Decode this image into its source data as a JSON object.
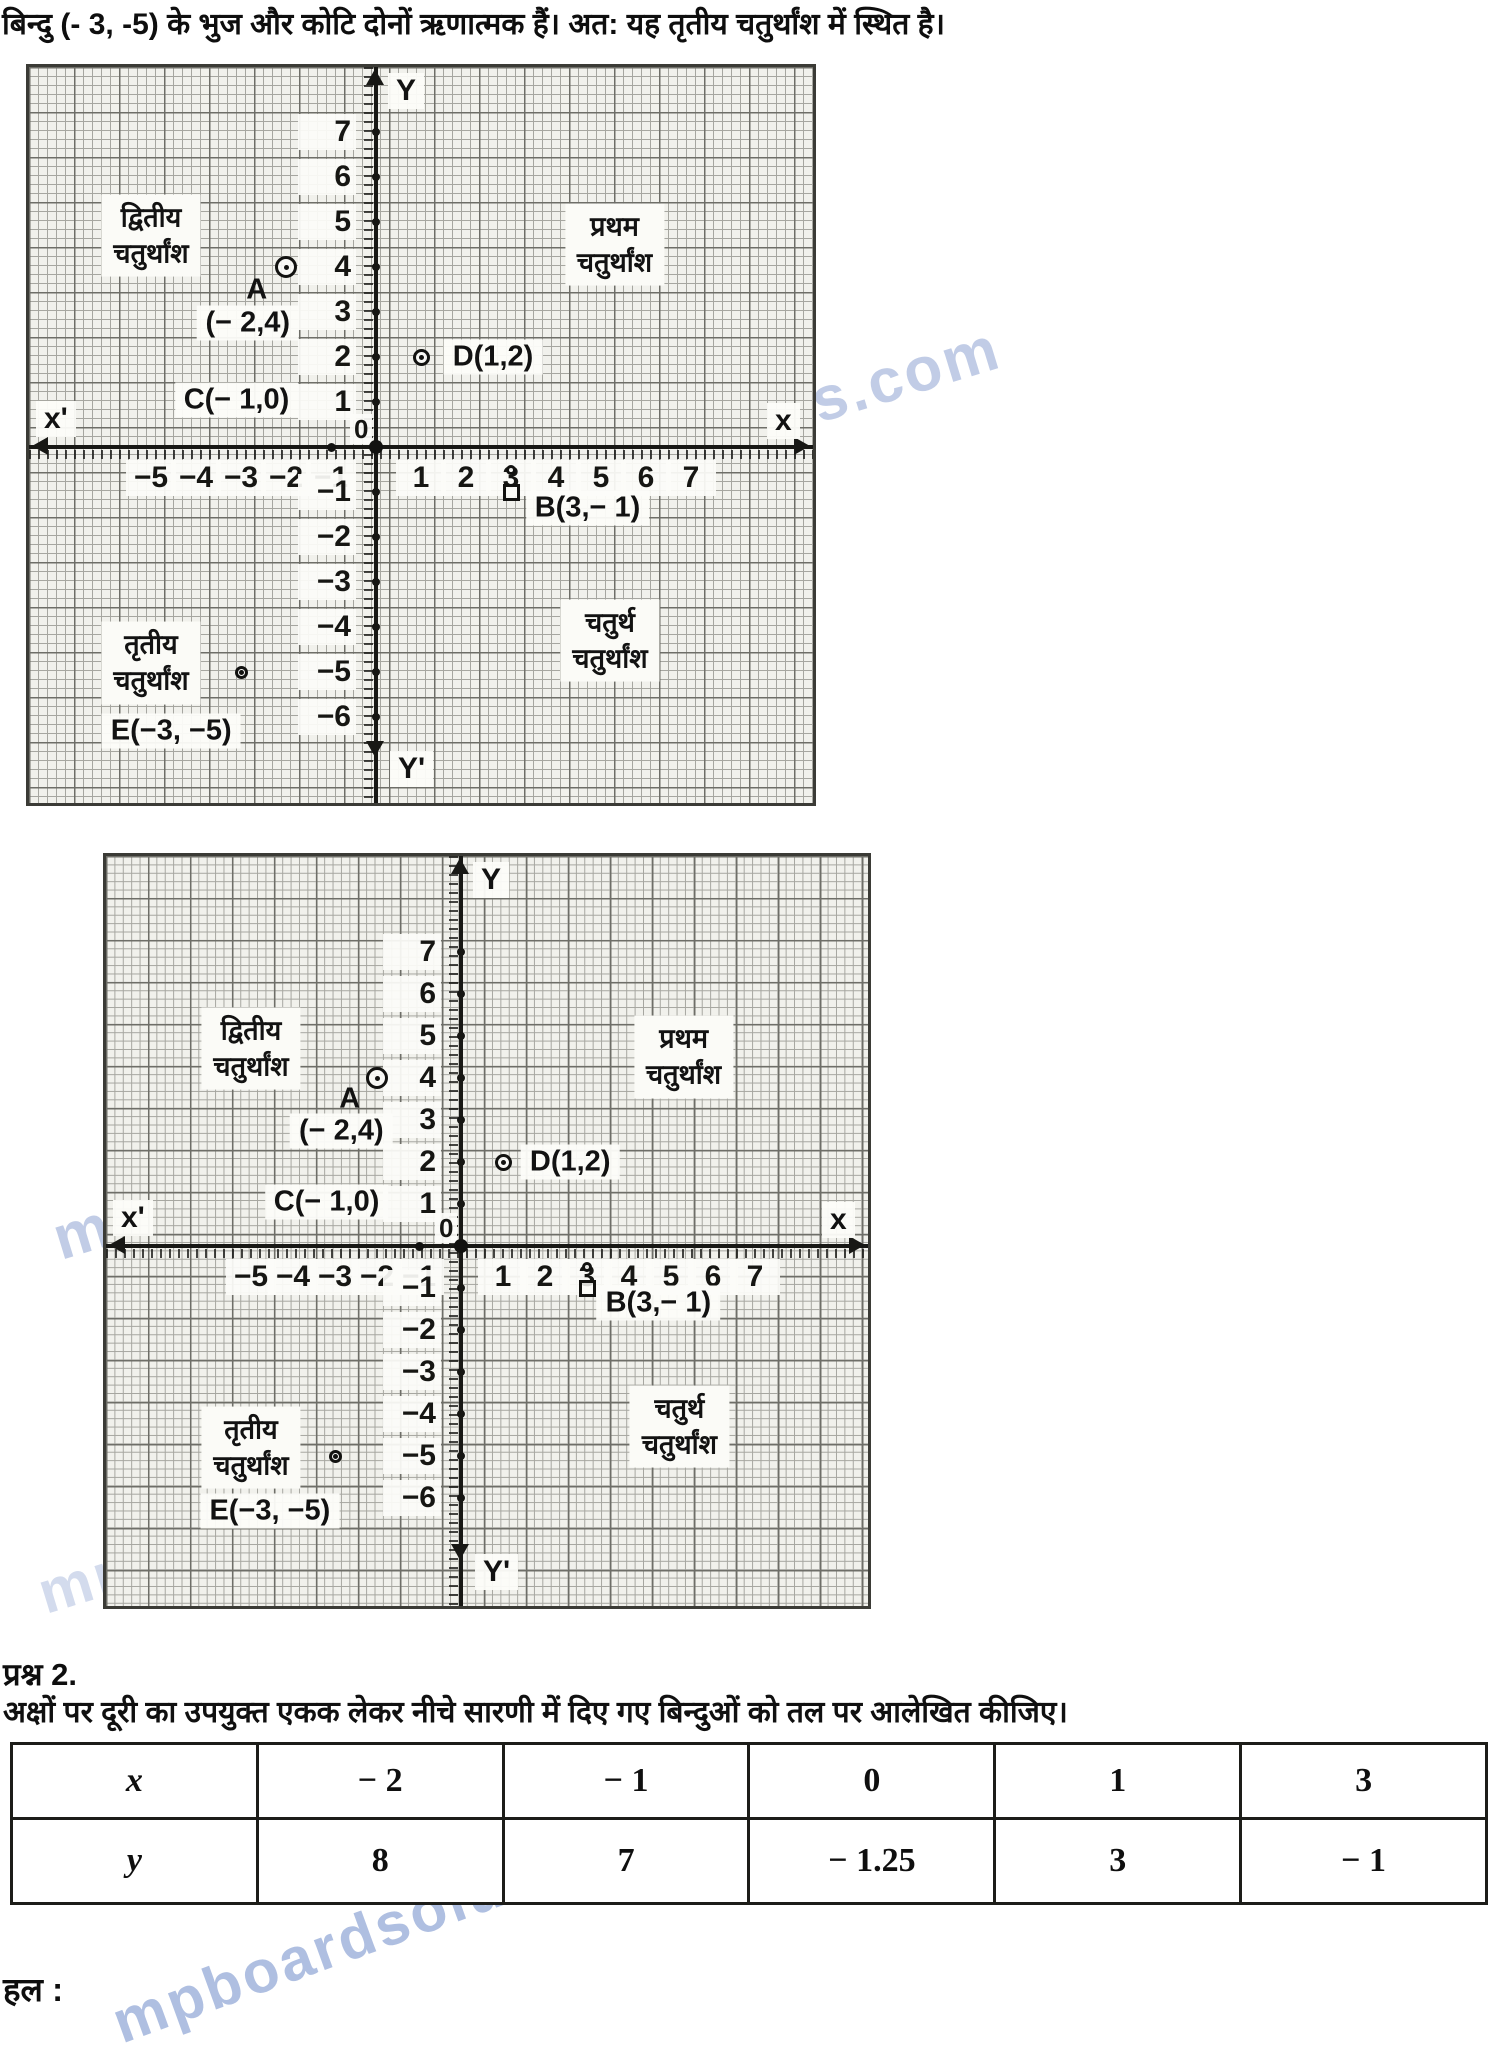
{
  "page": {
    "intro_line": "बिन्दु (- 3, -5) के भुज और कोटि दोनों ऋणात्मक हैं। अत: यह तृतीय चतुर्थांश में स्थित है।",
    "question_label": "प्रश्न 2.",
    "question_text": "अक्षों पर दूरी का उपयुक्त एकक लेकर नीचे सारणी में दिए गए बिन्दुओं को तल पर आलेखित कीजिए।",
    "solution_label": "हल :",
    "watermark_text": "mpboardsolutionss.com"
  },
  "chart_data": [
    {
      "type": "scatter",
      "figure": "1",
      "x_axis": {
        "left_label": "x'",
        "right_label": "x",
        "ticks": [
          -5,
          -4,
          -3,
          -2,
          -1,
          1,
          2,
          3,
          4,
          5,
          6,
          7
        ],
        "lim": [
          -7.5,
          9.5
        ]
      },
      "y_axis": {
        "top_label": "Y",
        "bottom_label": "Y'",
        "ticks": [
          7,
          6,
          5,
          4,
          3,
          2,
          1,
          0,
          -1,
          -2,
          -3,
          -4,
          -5,
          -6
        ],
        "lim": [
          -7.8,
          8.5
        ]
      },
      "origin_label": "0",
      "points": [
        {
          "name": "A",
          "x": -2,
          "y": 4,
          "marker": "circle-dot",
          "size": 22
        },
        {
          "name": "D",
          "x": 1,
          "y": 2,
          "marker": "circle-dot",
          "size": 17
        },
        {
          "name": "B",
          "x": 3,
          "y": -1,
          "marker": "square",
          "size": 17
        },
        {
          "name": "B-tick",
          "x": 3,
          "y": -0.5,
          "marker": "circle-dot",
          "size": 10
        },
        {
          "name": "E",
          "x": -3,
          "y": -5,
          "marker": "circle-dot",
          "size": 13
        },
        {
          "name": "C",
          "x": -1,
          "y": 0,
          "marker": "filled-dot",
          "size": 9
        },
        {
          "name": "O",
          "x": 0,
          "y": 0,
          "marker": "filled-dot",
          "size": 14
        }
      ],
      "point_labels": [
        {
          "text": "A",
          "u": -2.65,
          "v": 3.5,
          "boxed": false
        },
        {
          "text": "(− 2,4)",
          "u": -2.85,
          "v": 2.75,
          "boxed": true
        },
        {
          "text": "C(− 1,0)",
          "u": -3.1,
          "v": 1.05,
          "boxed": true
        },
        {
          "text": "D(1,2)",
          "u": 2.6,
          "v": 2.0,
          "boxed": true
        },
        {
          "text": "B(3,− 1)",
          "u": 4.7,
          "v": -1.35,
          "boxed": true
        },
        {
          "text": "E(−3, −5)",
          "u": -4.55,
          "v": -6.3,
          "boxed": true
        }
      ],
      "quadrant_labels": [
        {
          "line1": "द्वितीय",
          "line2": "चतुर्थांश",
          "u": -5.0,
          "v": 4.7
        },
        {
          "line1": "प्रथम",
          "line2": "चतुर्थांश",
          "u": 5.3,
          "v": 4.5
        },
        {
          "line1": "तृतीय",
          "line2": "चतुर्थांश",
          "u": -5.0,
          "v": -4.8
        },
        {
          "line1": "चतुर्थ",
          "line2": "चतुर्थांश",
          "u": 5.2,
          "v": -4.3
        }
      ]
    },
    {
      "type": "scatter",
      "figure": "2",
      "x_axis": {
        "left_label": "x'",
        "right_label": "x",
        "ticks": [
          -5,
          -4,
          -3,
          -2,
          -1,
          1,
          2,
          3,
          4,
          5,
          6,
          7
        ],
        "lim": [
          -8.4,
          9.6
        ]
      },
      "y_axis": {
        "top_label": "Y",
        "bottom_label": "Y'",
        "ticks": [
          7,
          6,
          5,
          4,
          3,
          2,
          1,
          0,
          -1,
          -2,
          -3,
          -4,
          -5,
          -6
        ],
        "lim": [
          -9.3,
          8.6
        ]
      },
      "origin_label": "0",
      "points": [
        {
          "name": "A",
          "x": -2,
          "y": 4,
          "marker": "circle-dot",
          "size": 22
        },
        {
          "name": "D",
          "x": 1,
          "y": 2,
          "marker": "circle-dot",
          "size": 17
        },
        {
          "name": "B",
          "x": 3,
          "y": -1,
          "marker": "square",
          "size": 17
        },
        {
          "name": "B-tick",
          "x": 3,
          "y": -0.5,
          "marker": "circle-dot",
          "size": 10
        },
        {
          "name": "E",
          "x": -3,
          "y": -5,
          "marker": "circle-dot",
          "size": 13
        },
        {
          "name": "C",
          "x": -1,
          "y": 0,
          "marker": "filled-dot",
          "size": 9
        },
        {
          "name": "O",
          "x": 0,
          "y": 0,
          "marker": "filled-dot",
          "size": 14
        }
      ],
      "point_labels": [
        {
          "text": "A",
          "u": -2.65,
          "v": 3.5,
          "boxed": false
        },
        {
          "text": "(− 2,4)",
          "u": -2.85,
          "v": 2.75,
          "boxed": true
        },
        {
          "text": "C(− 1,0)",
          "u": -3.2,
          "v": 1.05,
          "boxed": true
        },
        {
          "text": "D(1,2)",
          "u": 2.6,
          "v": 2.0,
          "boxed": true
        },
        {
          "text": "B(3,− 1)",
          "u": 4.7,
          "v": -1.35,
          "boxed": true
        },
        {
          "text": "E(−3, −5)",
          "u": -4.55,
          "v": -6.3,
          "boxed": true
        }
      ],
      "quadrant_labels": [
        {
          "line1": "द्वितीय",
          "line2": "चतुर्थांश",
          "u": -5.0,
          "v": 4.7
        },
        {
          "line1": "प्रथम",
          "line2": "चतुर्थांश",
          "u": 5.3,
          "v": 4.5
        },
        {
          "line1": "तृतीय",
          "line2": "चतुर्थांश",
          "u": -5.0,
          "v": -4.8
        },
        {
          "line1": "चतुर्थ",
          "line2": "चतुर्थांश",
          "u": 5.2,
          "v": -4.3
        }
      ]
    }
  ],
  "table": {
    "rows": [
      {
        "header": "x",
        "values": [
          "− 2",
          "− 1",
          "0",
          "1",
          "3"
        ]
      },
      {
        "header": "y",
        "values": [
          "8",
          "7",
          "− 1.25",
          "3",
          "− 1"
        ]
      }
    ]
  }
}
